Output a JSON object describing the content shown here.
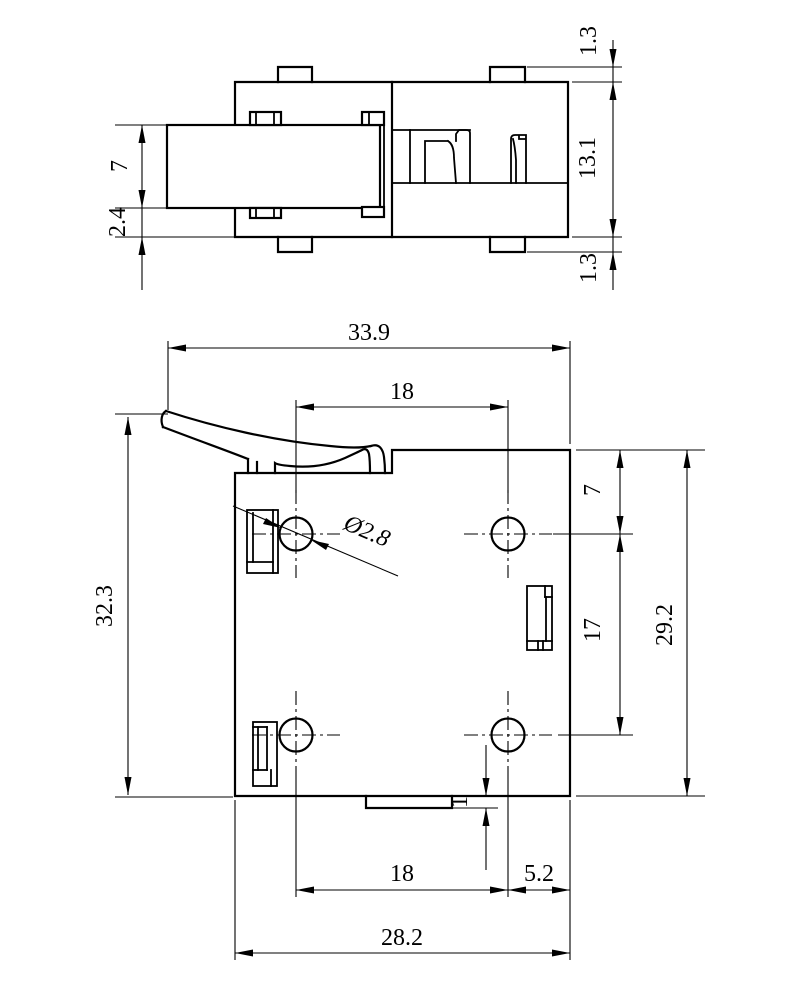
{
  "drawing": {
    "type": "engineering-2-view-drawing",
    "background_color": "#ffffff",
    "line_color": "#000000",
    "dims": {
      "top_view": {
        "plate_height": "7",
        "plate_offset": "2.4",
        "tab_height_top": "1.3",
        "body_height": "13.1",
        "tab_height_bottom": "1.3"
      },
      "front_view": {
        "overall_width": "33.9",
        "hole_pitch_top": "18",
        "overall_height": "32.3",
        "right_height": "29.2",
        "hole_top_offset": "7",
        "hole_row_pitch": "17",
        "hole_diameter": "Ø2.8",
        "bottom_tab_depth": "1",
        "hole_pitch_bottom": "18",
        "hole_right_offset": "5.2",
        "bottom_width": "28.2"
      }
    }
  }
}
